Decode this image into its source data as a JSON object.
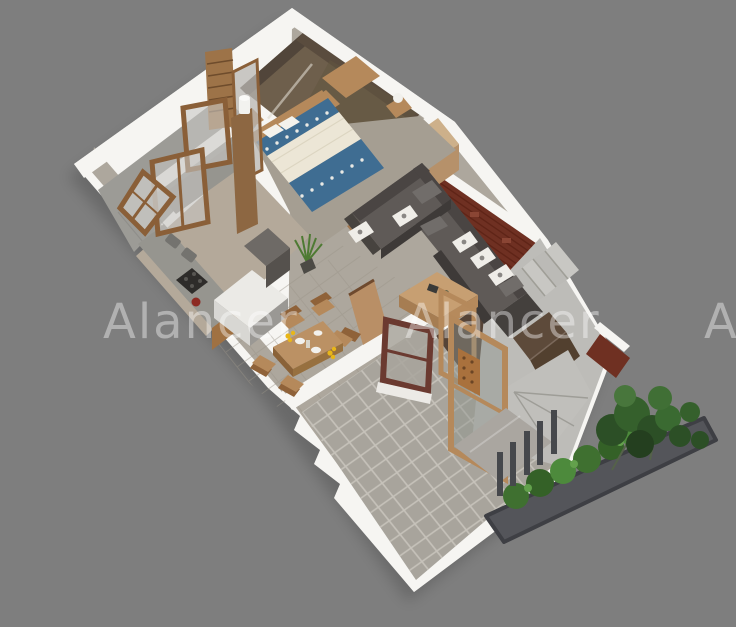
{
  "image": {
    "kind": "3d-isometric-floor-plan-render",
    "width": 736,
    "height": 627
  },
  "watermark": {
    "text": "Alancer",
    "color": "#ffffff",
    "opacity": 0.4,
    "instances": 3
  },
  "palette": {
    "bg": "#7e7e7e",
    "wall": "#f6f5f2",
    "wallShade": "#e2e0dc",
    "interiorFloor": "#ada79d",
    "bathroomFloor": "#6e5f4c",
    "balconyFloor": "#9c9b96",
    "courtyardTile": "#a8a49c",
    "tileGrout": "#c6c2ba",
    "hallGrout": "#9b9589",
    "brick": "#6f3022",
    "brickDark": "#571f12",
    "woodLight": "#cdb08a",
    "wood": "#b5895b",
    "woodDark": "#8a5f38",
    "maroon": "#6b3a30",
    "sofa": "#5f5a57",
    "sofaDark": "#4a4543",
    "bedBlue": "#3f6d92",
    "bedCream": "#ece6d6",
    "counter": "#96958f",
    "stairs": "#c8c7c3",
    "stairsZone": "#bdbcb8",
    "underStair": "#564437",
    "planter": "#54555a",
    "leaf": "#3f7030",
    "leafDark": "#2c4f26",
    "leafLight": "#4d8a3c",
    "post": "#46484c",
    "glass": "#8e958f",
    "watermarkColor": "#ffffff",
    "watermarkOpacity": 0.4
  }
}
